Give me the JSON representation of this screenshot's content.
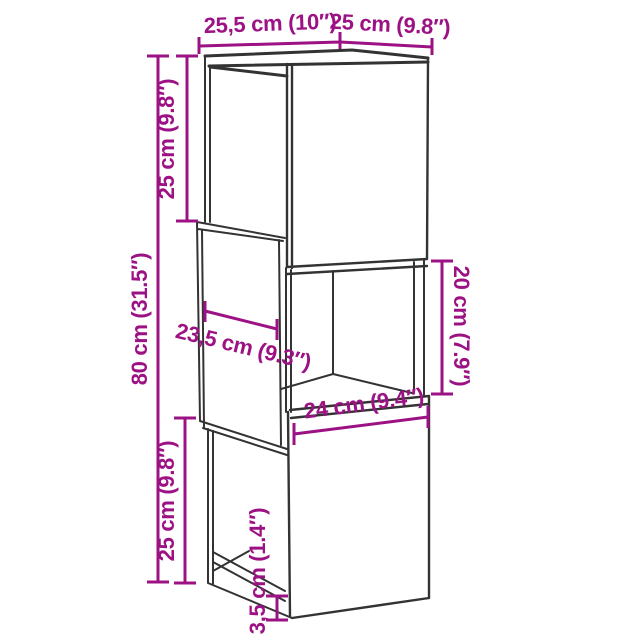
{
  "diagram": {
    "type": "furniture-dimension-drawing",
    "subject": "3-section cabinet",
    "colors": {
      "dimension": "#9C1284",
      "outline": "#333333",
      "background": "#FFFFFF"
    },
    "labels": {
      "top_width": "25,5 cm (10″)",
      "top_depth": "25 cm (9.8″)",
      "upper_section_height": "25 cm (9.8″)",
      "total_height": "80 cm (31.5″)",
      "lower_section_height": "25 cm (9.8″)",
      "inner_depth": "23,5 cm (9.3″)",
      "inner_width": "24 cm (9.4″)",
      "inner_height": "20 cm (7.9″)",
      "base_height": "3,5 cm (1.4″)"
    }
  }
}
